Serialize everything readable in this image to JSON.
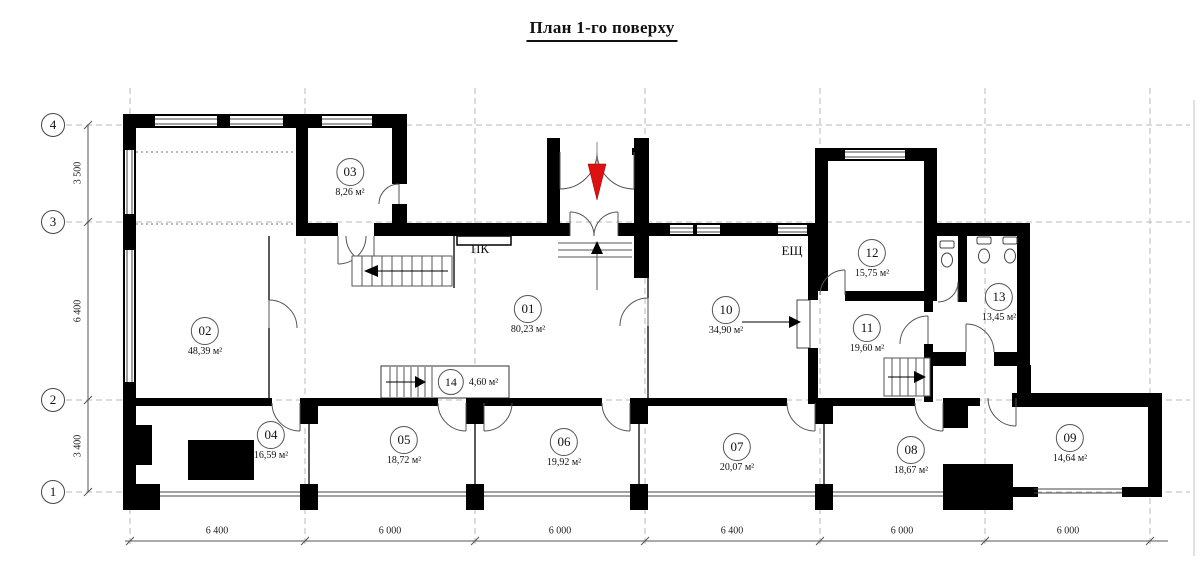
{
  "title": "План 1-го поверху",
  "axis": {
    "row_labels": [
      "4",
      "3",
      "2",
      "1"
    ],
    "row_dimensions": [
      "3 500",
      "6 400",
      "3 400"
    ],
    "col_dimensions": [
      "6 400",
      "6 000",
      "6 000",
      "6 400",
      "6 000",
      "6 000"
    ]
  },
  "annotations": {
    "pk": "ПК",
    "esch": "ЕЩ"
  },
  "rooms": [
    {
      "number": "01",
      "area": "80,23 м²"
    },
    {
      "number": "02",
      "area": "48,39 м²"
    },
    {
      "number": "03",
      "area": "8,26 м²"
    },
    {
      "number": "04",
      "area": "16,59 м²"
    },
    {
      "number": "05",
      "area": "18,72 м²"
    },
    {
      "number": "06",
      "area": "19,92 м²"
    },
    {
      "number": "07",
      "area": "20,07 м²"
    },
    {
      "number": "08",
      "area": "18,67 м²"
    },
    {
      "number": "09",
      "area": "14,64 м²"
    },
    {
      "number": "10",
      "area": "34,90 м²"
    },
    {
      "number": "11",
      "area": "19,60 м²"
    },
    {
      "number": "12",
      "area": "15,75 м²"
    },
    {
      "number": "13",
      "area": "13,45 м²"
    },
    {
      "number": "14",
      "area": "4,60 м²"
    }
  ],
  "colors": {
    "wall": "#000000",
    "line": "#555555",
    "grid": "#b8b8b8",
    "entry_arrow": "#dd1111"
  }
}
